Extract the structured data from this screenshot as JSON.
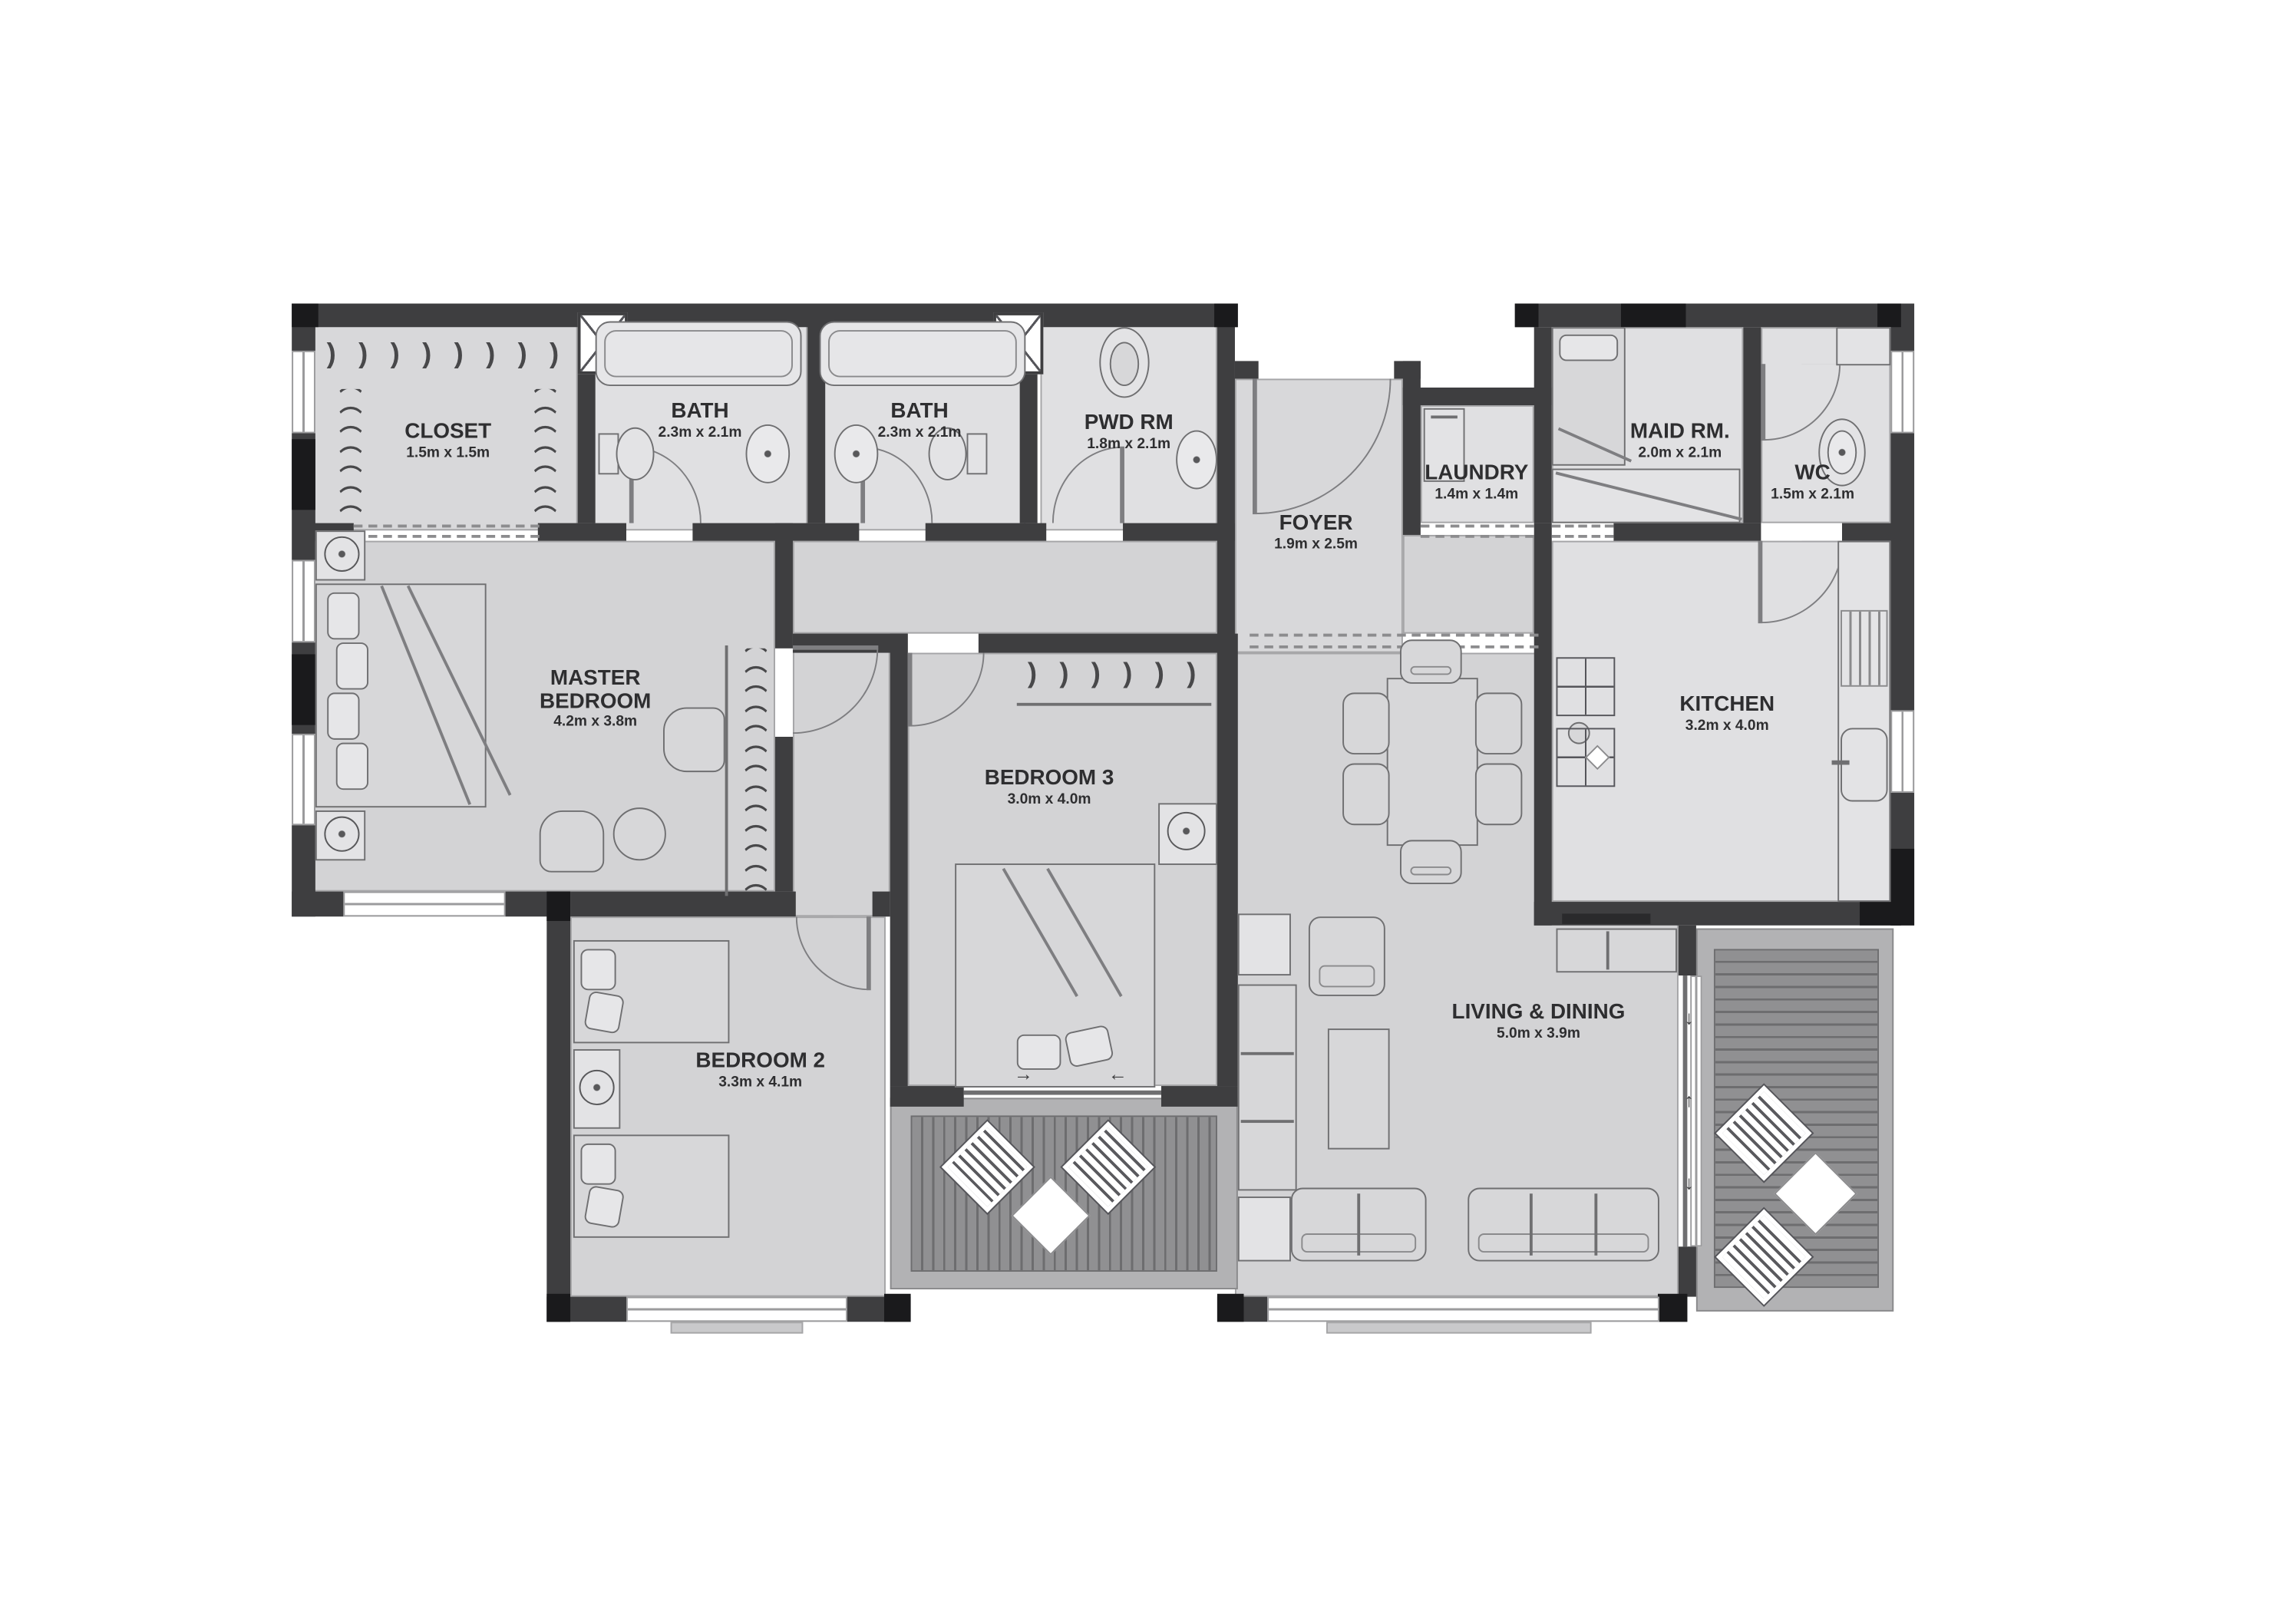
{
  "plan_type": "apartment-floor-plan",
  "colors": {
    "wall": "#3e3e40",
    "floor": "#d3d3d5",
    "floor_light": "#e0e0e2",
    "deck": "#919193",
    "deck_frame": "#b2b2b4",
    "outline": "#6f6f71",
    "text": "#2e2e30",
    "black_column": "#1a1a1c",
    "white": "#ffffff"
  },
  "icons": {
    "arc": "⌒",
    "paren": ")",
    "arrow_right": "→",
    "arrow_left": "←",
    "arrow_up": "↑",
    "arrow_down": "↓"
  },
  "rooms": {
    "closet": {
      "name": "CLOSET",
      "dims": "1.5m x 1.5m"
    },
    "bath1": {
      "name": "BATH",
      "dims": "2.3m x 2.1m"
    },
    "bath2": {
      "name": "BATH",
      "dims": "2.3m x 2.1m"
    },
    "pwd": {
      "name": "PWD RM",
      "dims": "1.8m x 2.1m"
    },
    "foyer": {
      "name": "FOYER",
      "dims": "1.9m x 2.5m"
    },
    "laundry": {
      "name": "LAUNDRY",
      "dims": "1.4m x 1.4m"
    },
    "maid": {
      "name": "MAID RM.",
      "dims": "2.0m x 2.1m"
    },
    "wc": {
      "name": "WC",
      "dims": "1.5m x 2.1m"
    },
    "master": {
      "name": "MASTER BEDROOM",
      "dims": "4.2m x 3.8m"
    },
    "bedroom3": {
      "name": "BEDROOM 3",
      "dims": "3.0m x 4.0m"
    },
    "bedroom2": {
      "name": "BEDROOM 2",
      "dims": "3.3m x 4.1m"
    },
    "kitchen": {
      "name": "KITCHEN",
      "dims": "3.2m x 4.0m"
    },
    "living": {
      "name": "LIVING & DINING",
      "dims": "5.0m x 3.9m"
    }
  }
}
